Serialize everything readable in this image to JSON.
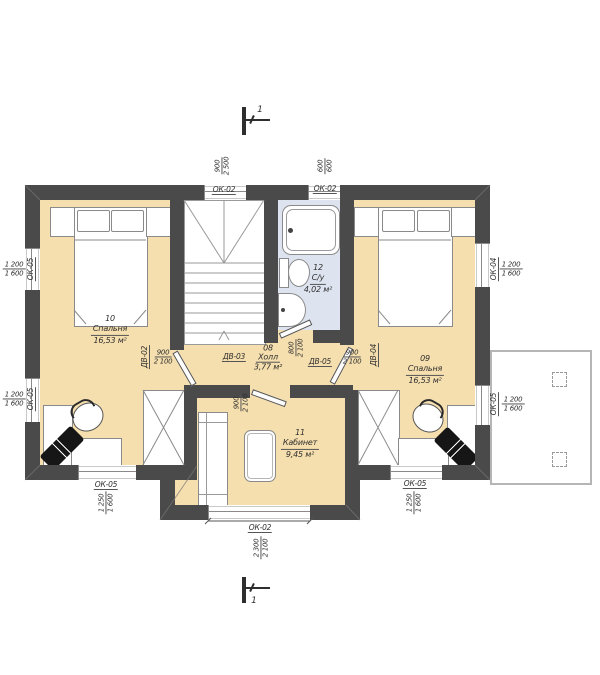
{
  "section_marks": {
    "top": "1",
    "bottom": "1"
  },
  "rooms": {
    "bedroom10": {
      "number": "10",
      "name": "Спальня",
      "area": "16,53 м²"
    },
    "bedroom09": {
      "number": "09",
      "name": "Спальня",
      "area": "16,53 м²"
    },
    "study11": {
      "number": "11",
      "name": "Кабинет",
      "area": "9,45 м²"
    },
    "bath12": {
      "number": "12",
      "name": "С/у",
      "area": "4,02 м²"
    },
    "hall08": {
      "number": "08",
      "name": "Холл",
      "area": "3,77 м²"
    }
  },
  "windows": {
    "top_center": {
      "mark": "ОК-02",
      "w": "900",
      "h": "2 500"
    },
    "top_right": {
      "mark": "ОК-02",
      "w": "600",
      "h": "600"
    },
    "left_upper": {
      "mark": "ОК-05",
      "w": "1 200",
      "h": "1 600"
    },
    "left_lower": {
      "mark": "ОК-05",
      "w": "1 200",
      "h": "1 600"
    },
    "right_upper": {
      "mark": "ОК-04",
      "w": "1 200",
      "h": "1 600"
    },
    "right_lower": {
      "mark": "ОК-05",
      "w": "1 200",
      "h": "1 600"
    },
    "bottom_left": {
      "mark": "ОК-05",
      "w": "1 250",
      "h": "1 600"
    },
    "bottom_center": {
      "mark": "ОК-02",
      "w": "2 300",
      "h": "2 100"
    },
    "bottom_right": {
      "mark": "ОК-05",
      "w": "1 250",
      "h": "1 600"
    }
  },
  "doors": {
    "dv02": {
      "mark": "ДВ-02",
      "w": "900",
      "h": "2 100"
    },
    "dv03": {
      "mark": "ДВ-03",
      "w": "900",
      "h": "2 100"
    },
    "dv04": {
      "mark": "ДВ-04",
      "w": "900",
      "h": "2 100"
    },
    "dv05": {
      "mark": "ДВ-05",
      "w": "800",
      "h": "2 100"
    }
  },
  "colors": {
    "wall": "#4a4a4a",
    "floor": "#f6dfae",
    "bath_floor": "#dee4ef",
    "line": "#8a8a8a",
    "text": "#2e2e2e"
  }
}
